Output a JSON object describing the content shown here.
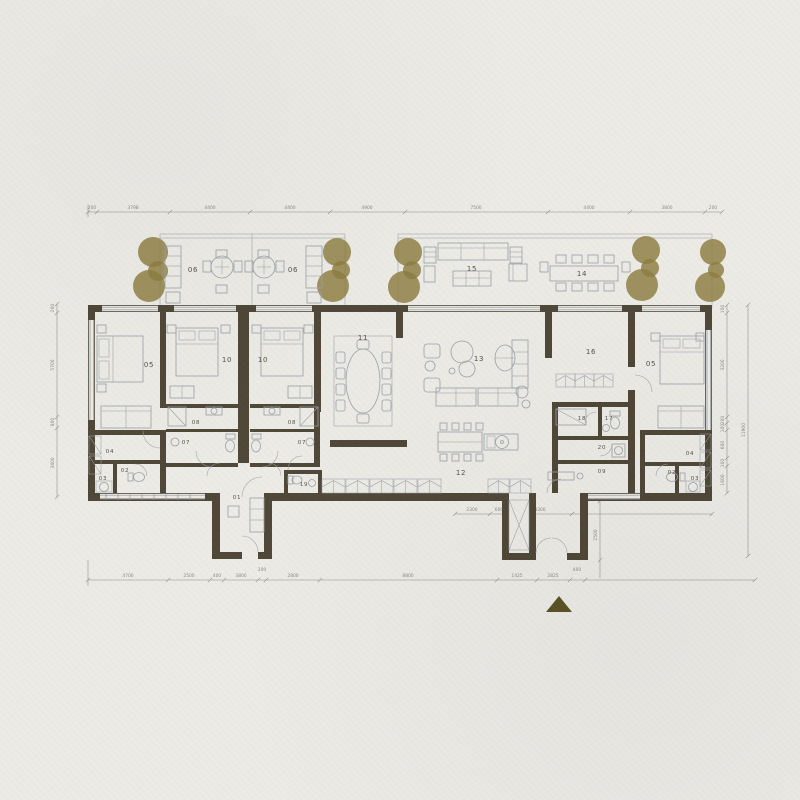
{
  "colors": {
    "paper": "#ecebe6",
    "wall": "#4f4737",
    "furn": "#9aa1a8",
    "tree": "#8c7d40",
    "dim": "#8b8b86",
    "label": "#55514a",
    "arrow": "#5b5226",
    "winl": "#8f979e"
  },
  "rooms": [
    {
      "label": "06"
    },
    {
      "label": "06"
    },
    {
      "label": "15"
    },
    {
      "label": "14"
    },
    {
      "label": "05"
    },
    {
      "label": "10"
    },
    {
      "label": "10"
    },
    {
      "label": "11"
    },
    {
      "label": "13"
    },
    {
      "label": "16"
    },
    {
      "label": "05"
    },
    {
      "label": "08"
    },
    {
      "label": "07"
    },
    {
      "label": "08"
    },
    {
      "label": "07"
    },
    {
      "label": "04"
    },
    {
      "label": "02"
    },
    {
      "label": "03"
    },
    {
      "label": "01"
    },
    {
      "label": "19"
    },
    {
      "label": "12"
    },
    {
      "label": "18"
    },
    {
      "label": "17"
    },
    {
      "label": "20"
    },
    {
      "label": "09"
    },
    {
      "label": "04"
    },
    {
      "label": "02"
    },
    {
      "label": "03"
    }
  ],
  "dimensions": {
    "top": [
      "200",
      "3798",
      "4400",
      "4400",
      "4900",
      "7500",
      "4400",
      "3800",
      "200"
    ],
    "bottom": [
      "4700",
      "2500",
      "400",
      "3800",
      "200",
      "2800",
      "8800",
      "1425",
      "2825",
      "400"
    ],
    "left": [
      "200",
      "5700",
      "800",
      "3400"
    ],
    "right_inner": [
      "100",
      "3200",
      "200",
      "100",
      "600",
      "100",
      "1600"
    ],
    "right_outer": [
      "11900"
    ],
    "bottom_right": [
      "2300",
      "600",
      "4300"
    ],
    "entry": [
      "2500"
    ]
  }
}
